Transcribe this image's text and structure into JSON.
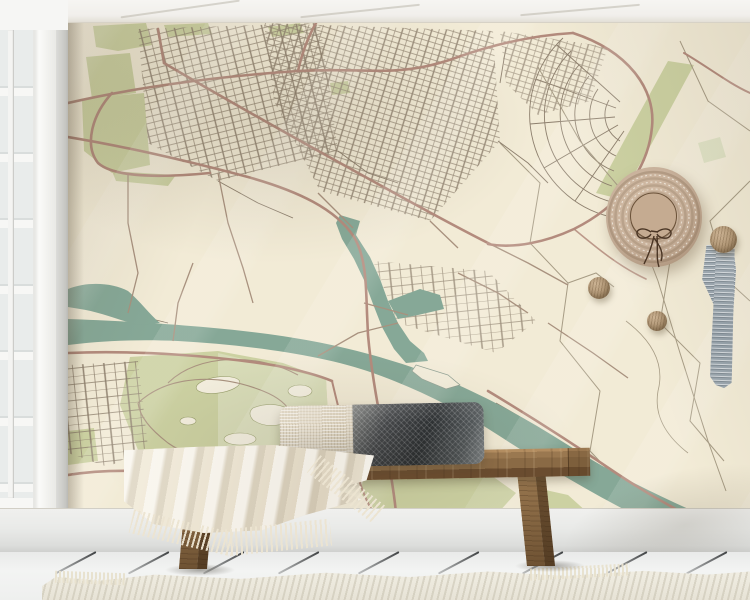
{
  "meta": {
    "title": "Interior mockup — vintage city map wall mural",
    "text_visible_in_image": "none"
  },
  "scene": {
    "mural": {
      "label": "vintage street map wall mural",
      "style": "retro minimal city map without text labels",
      "features": [
        "dense street grid in upper left and centre",
        "fan of concentric crescent streets right of centre",
        "teal river crossing from left to lower right",
        "harbour canal branch with small island",
        "sage green parks and bottom-left park with ponds",
        "dusty-rose main roads",
        "thin field and dike boundary lines on countryside at right"
      ]
    },
    "window": {
      "label": "white french window, left edge",
      "pane_rows": 7
    },
    "ceiling": {
      "label": "white ceiling strip"
    },
    "bench": {
      "label": "rustic wooden bench",
      "legs": 2
    },
    "pillow": {
      "label": "lumbar cushion, cream weave left / charcoal herringbone right"
    },
    "blanket": {
      "label": "cream throw blanket with fringe"
    },
    "hat": {
      "label": "straw hat with dark ribbon bow"
    },
    "hooks": {
      "label": "round wooden wall knobs",
      "count": 3
    },
    "scarf": {
      "label": "grey striped scarf hanging from knob"
    },
    "baseboard": {
      "label": "white baseboard"
    },
    "floor": {
      "label": "white plank floor with diagonal seams"
    },
    "rug": {
      "label": "cream woven rug along bottom edge"
    }
  },
  "colors": {
    "map_bg": "#f2ebd6",
    "water": "#86a897",
    "green": "#ccd1a2",
    "green_light": "#dcdfbf",
    "road_major": "#b38b7d",
    "road_medium": "#a8917e",
    "road_minor": "#8d7f6d",
    "field_line": "#a79c85",
    "pond_fill": "#f4efdf",
    "pond_outline": "#9aa06e",
    "island_fill": "#f2ecd8",
    "window_frame": "#f7f7f5",
    "glass": "#e9eceb",
    "hat_straw": "#c8b19b",
    "hat_crown": "#c5ab91",
    "hat_ribbon": "#4a3524",
    "scarf": "#9aa5ac",
    "knob_wood": "#aa906f",
    "bench_wood": "#8a6a45",
    "blanket": "#ede6d5",
    "pillow_dark": "#36393c",
    "pillow_light": "#ddd3c0"
  }
}
